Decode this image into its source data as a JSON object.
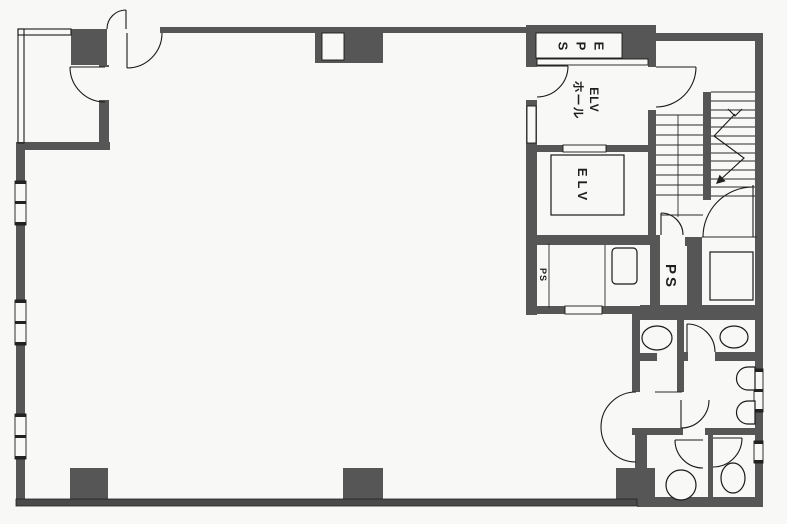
{
  "page": {
    "title": "Building floor plan"
  },
  "rooms": {
    "eps": {
      "label": "EPS"
    },
    "elevator_hall": {
      "label_line1": "ELV",
      "label_line2": "ホール"
    },
    "elevator": {
      "label": "ELV"
    },
    "pipe_shaft_small": {
      "label": "PS"
    },
    "pipe_shaft_large": {
      "label": "PS"
    }
  },
  "colors": {
    "wall": "#565656",
    "line": "#1a1a1a",
    "background": "#f8f8f6"
  }
}
